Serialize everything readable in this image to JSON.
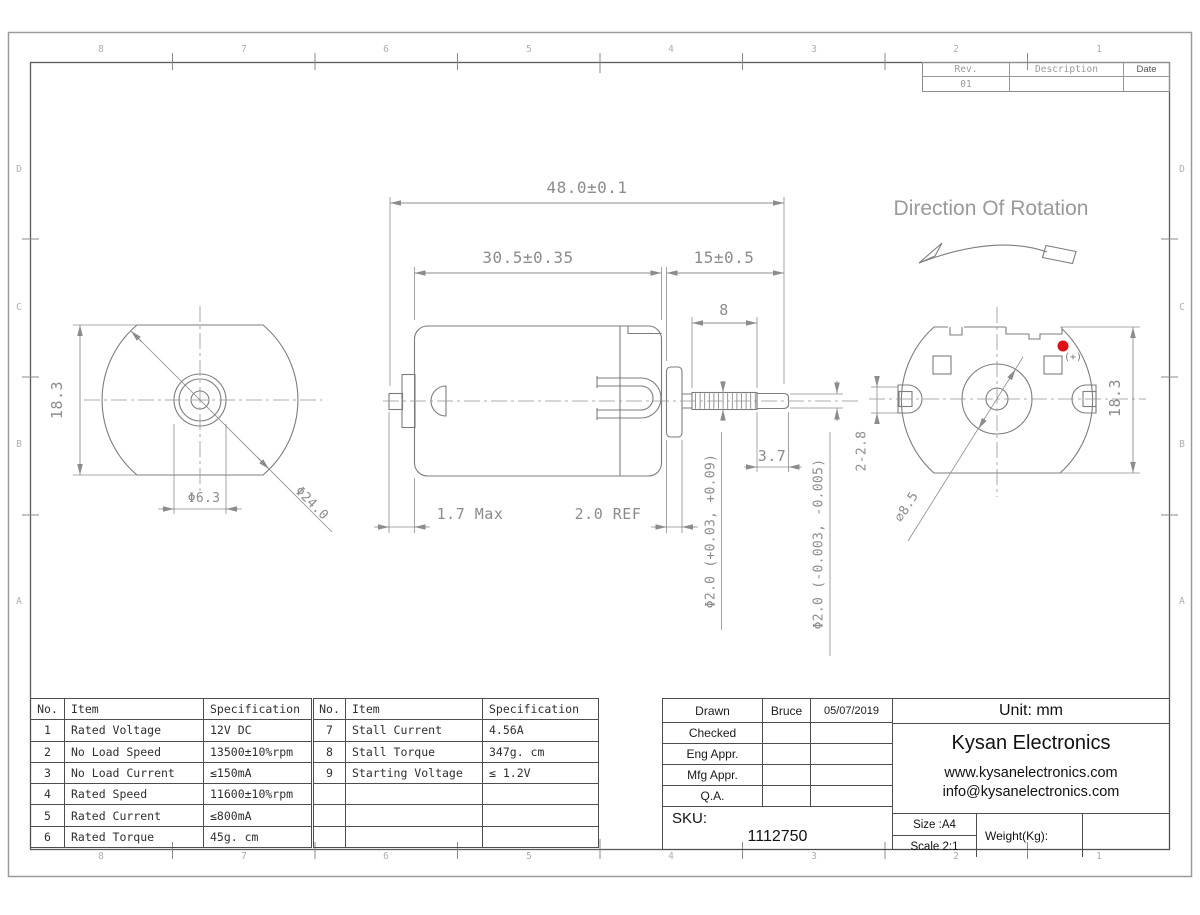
{
  "sheet": {
    "cols": [
      "8",
      "7",
      "6",
      "5",
      "4",
      "3",
      "2",
      "1"
    ],
    "rows": [
      "D",
      "C",
      "B",
      "A"
    ]
  },
  "revision": {
    "headers": [
      "Rev.",
      "Description",
      "Date"
    ],
    "rows": [
      {
        "rev": "01",
        "description": "",
        "date": ""
      }
    ]
  },
  "drawing": {
    "direction_of_rotation": "Direction Of Rotation",
    "polarity": "(+)",
    "polarity_dot_color": "#dd1111",
    "dims": {
      "overall_length": "48.0±0.1",
      "body_length": "30.5±0.35",
      "shaft_extension": "15±0.5",
      "knurl_length": "8",
      "shaft_tip_length": "3.7",
      "front_boss_length": "1.7 Max",
      "rear_boss_length": "2.0 REF",
      "body_height_front": "18.3",
      "body_height_rear": "18.3",
      "front_bushing_dia": "Φ6.3",
      "body_dia": "Φ24.0",
      "knurl_dia": "Φ2.0 (+0.03, +0.09)",
      "shaft_tip_dia": "Φ2.0 (-0.003, -0.005)",
      "rear_boss_dia": "∅8.5",
      "terminal_size": "2-2.8"
    }
  },
  "spec_table": {
    "rows": [
      [
        "No.",
        "Item",
        "Specification",
        "No.",
        "Item",
        "Specification"
      ],
      [
        "1",
        "Rated Voltage",
        "12V DC",
        "7",
        "Stall Current",
        "4.56A"
      ],
      [
        "2",
        "No Load Speed",
        "13500±10%rpm",
        "8",
        "Stall Torque",
        "347g. cm"
      ],
      [
        "3",
        "No Load Current",
        "≤150mA",
        "9",
        "Starting Voltage",
        "≤ 1.2V"
      ],
      [
        "4",
        "Rated Speed",
        "11600±10%rpm",
        "",
        "",
        ""
      ],
      [
        "5",
        "Rated Current",
        "≤800mA",
        "",
        "",
        ""
      ],
      [
        "6",
        "Rated Torque",
        "45g. cm",
        "",
        "",
        ""
      ]
    ]
  },
  "title_block": {
    "approvals": [
      {
        "label": "Drawn",
        "name": "Bruce",
        "date": "05/07/2019"
      },
      {
        "label": "Checked",
        "name": "",
        "date": ""
      },
      {
        "label": "Eng Appr.",
        "name": "",
        "date": ""
      },
      {
        "label": "Mfg Appr.",
        "name": "",
        "date": ""
      },
      {
        "label": "Q.A.",
        "name": "",
        "date": ""
      }
    ],
    "sku_label": "SKU:",
    "sku_value": "1112750",
    "unit": "Unit: mm",
    "company": "Kysan Electronics",
    "website": "www.kysanelectronics.com",
    "email": "info@kysanelectronics.com",
    "size": "Size :A4",
    "scale": "Scale 2:1",
    "weight": "Weight(Kg):"
  }
}
